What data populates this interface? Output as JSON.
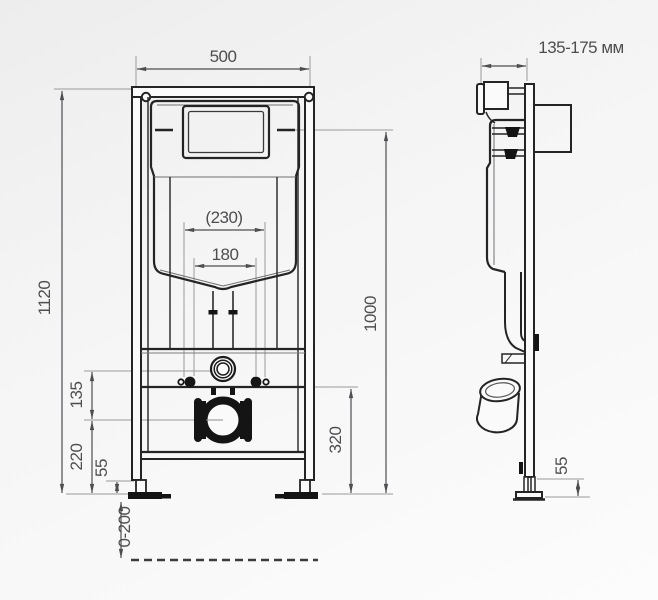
{
  "title": "wc-installation-frame-dimension-drawing",
  "colors": {
    "background_top": "#ededee",
    "background_bottom": "#fcfcfc",
    "outline": "#232323",
    "dimension": "#4e4e50",
    "text": "#4e4e50"
  },
  "front_view": {
    "dims": {
      "frame_width": "500",
      "overall_height": "1120",
      "stud_spacing_outer": "(230)",
      "stud_spacing_inner": "180",
      "inlet_to_outlet": "135",
      "outlet_center_height": "220",
      "foot_min_height": "55",
      "floor_adjustment_range": "0-200",
      "outlet_height_right": "320",
      "flush_connection_height": "1000"
    }
  },
  "side_view": {
    "dims": {
      "depth_range": "135-175 мм",
      "foot_min_height": "55"
    }
  }
}
